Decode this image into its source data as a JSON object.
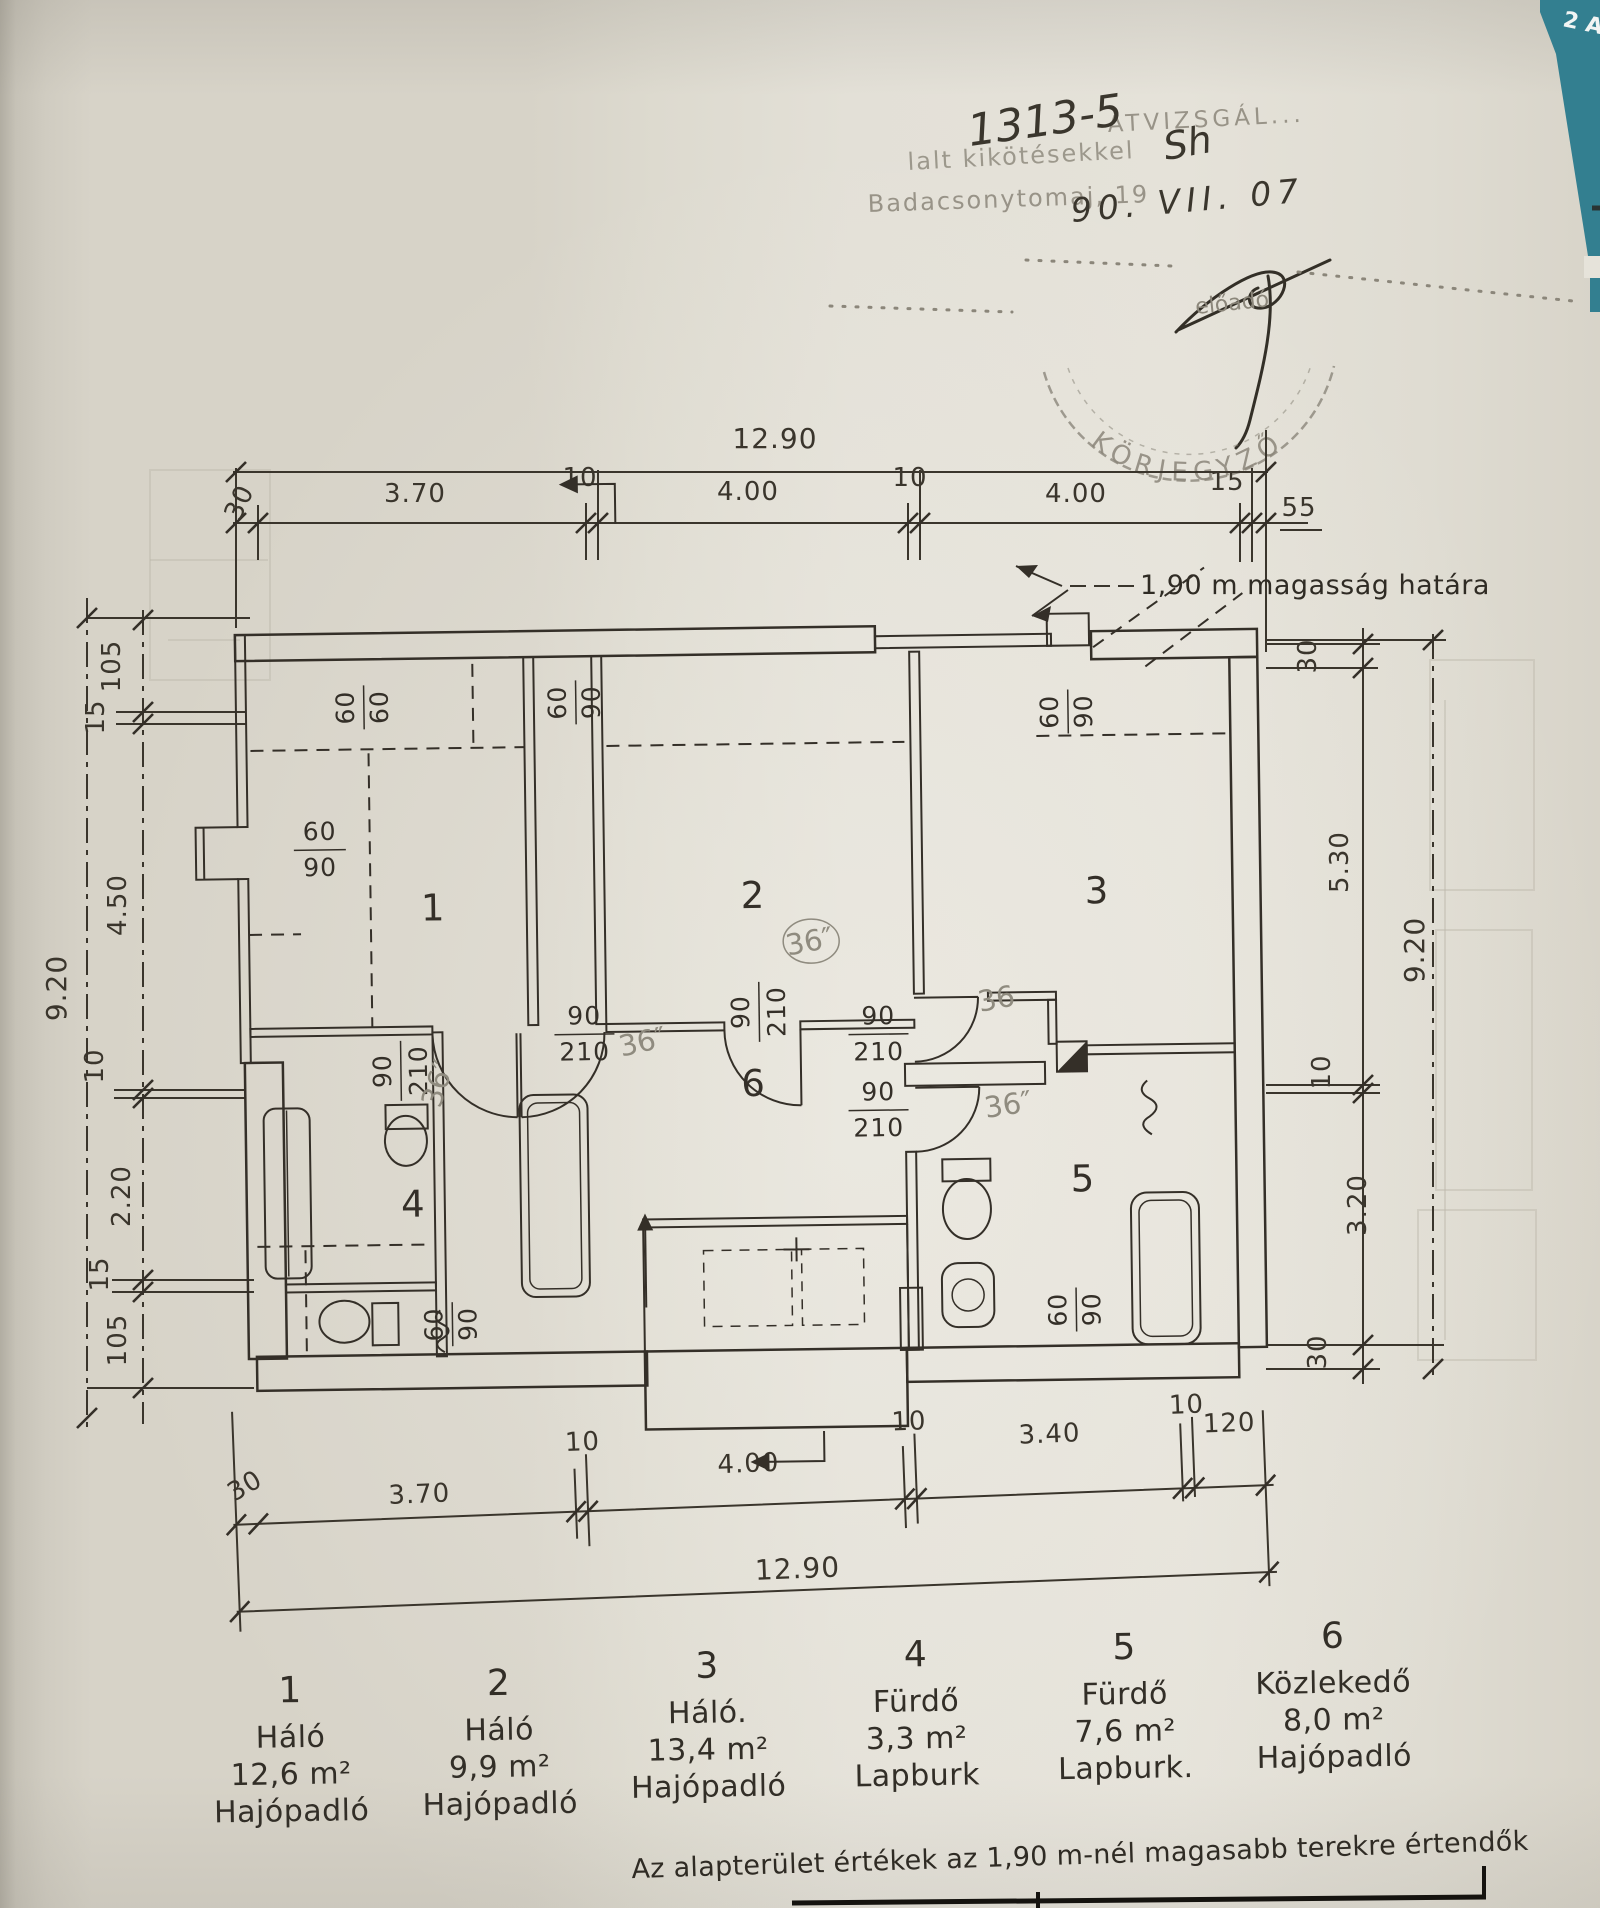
{
  "corner": {
    "tab_text": "2 A"
  },
  "stamp": {
    "top_line": "ÁTVIZSGÁL...",
    "number": "1313-5",
    "number_suffix": "Sh",
    "conditions_line": "lalt kikötésekkel",
    "place_line": "Badacsonytomaj, 19",
    "date_handwritten": "90. VII. 07",
    "clerk_label": "előadó",
    "round_stamp_text": "KÖRJEGYZŐ"
  },
  "height_boundary_note": "1,90 m magasság határa",
  "dims": {
    "top_overall": "12.90",
    "top_chain": [
      "30",
      "3.70",
      "10",
      "4.00",
      "10",
      "4.00",
      "15",
      "55"
    ],
    "bottom_overall": "12.90",
    "bottom_chain": [
      "30",
      "3.70",
      "10",
      "4.00",
      "10",
      "3.40",
      "10",
      "120"
    ],
    "left_overall": "9.20",
    "left_chain": [
      "105",
      "15",
      "4.50",
      "10",
      "2.20",
      "15",
      "105"
    ],
    "right_overall": "9.20",
    "right_chain": [
      "30",
      "5.30",
      "10",
      "3.20",
      "30"
    ]
  },
  "rooms": {
    "r1": "1",
    "r2": "2",
    "r3": "3",
    "r4": "4",
    "r5": "5",
    "r6": "6"
  },
  "openings": {
    "w6060": {
      "num": "60",
      "den": "60"
    },
    "w6090": {
      "num": "60",
      "den": "90"
    },
    "d90210": {
      "num": "90",
      "den": "210"
    },
    "note36": "36″",
    "note36plain": "36"
  },
  "legend": {
    "items": [
      {
        "number": "1",
        "name": "Háló",
        "area": "12,6 m²",
        "floor": "Hajópadló"
      },
      {
        "number": "2",
        "name": "Háló",
        "area": "9,9 m²",
        "floor": "Hajópadló"
      },
      {
        "number": "3",
        "name": "Háló.",
        "area": "13,4 m²",
        "floor": "Hajópadló"
      },
      {
        "number": "4",
        "name": "Fürdő",
        "area": "3,3 m²",
        "floor": "Lapburk"
      },
      {
        "number": "5",
        "name": "Fürdő",
        "area": "7,6 m²",
        "floor": "Lapburk."
      },
      {
        "number": "6",
        "name": "Közlekedő",
        "area": "8,0 m²",
        "floor": "Hajópadló"
      }
    ]
  },
  "footer_note": "Az alapterület értékek az 1,90 m-nél magasabb terekre értendők"
}
